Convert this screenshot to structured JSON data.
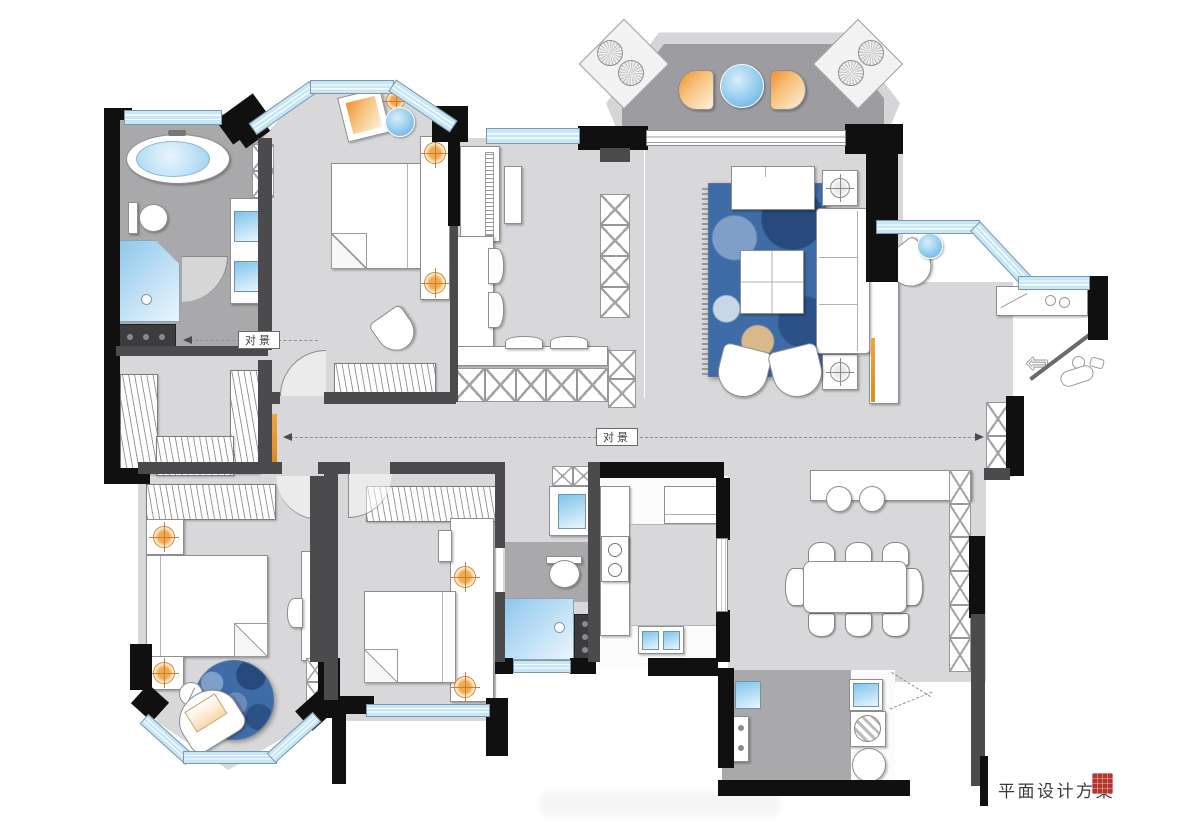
{
  "meta": {
    "drawing_type": "residential floor plan"
  },
  "annotations": {
    "sightline_left": "对景",
    "sightline_center": "对景"
  },
  "title_block": {
    "title": "平面设计方案"
  },
  "palette": {
    "exterior_wall": "#101010",
    "partition_wall": "#4b4b4d",
    "floor_light": "#d8d8da",
    "floor_dark": "#a9a9ab",
    "window_blue": "#c5e7f8",
    "accent_orange": "#f2a94e",
    "rug_blue": "#3e6ca6",
    "seal_red": "#b5342c"
  }
}
